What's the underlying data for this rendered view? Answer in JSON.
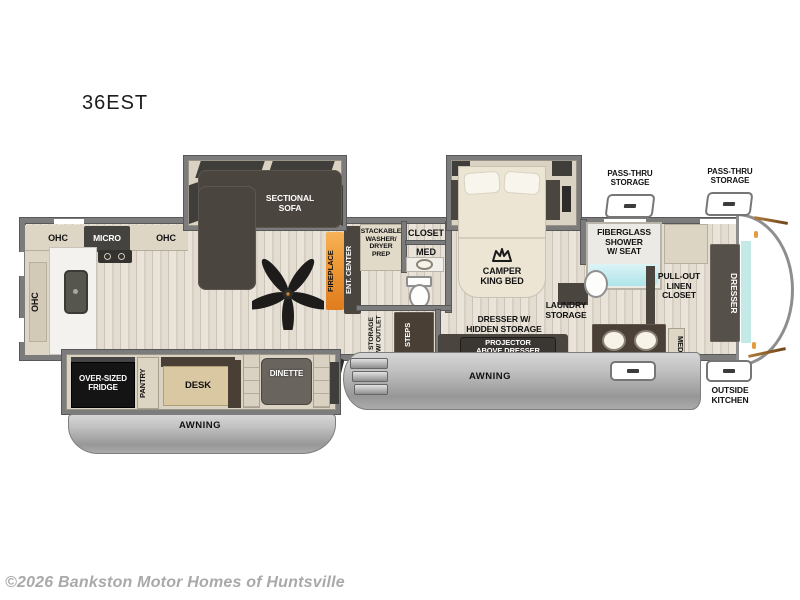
{
  "title": "36EST",
  "copyright": "©2026 Bankston Motor Homes of Huntsville",
  "labels": {
    "ohc": "OHC",
    "micro": "MICRO",
    "sectional_sofa": "SECTIONAL\nSOFA",
    "fireplace": "FIREPLACE",
    "ent_center": "ENT. CENTER",
    "stackable": "STACKABLE\nWASHER/\nDRYER\nPREP",
    "closet": "CLOSET",
    "med": "MED",
    "camper_king_bed": "CAMPER\nKING BED",
    "pass_thru": "PASS-THRU\nSTORAGE",
    "fiberglass_shower": "FIBERGLASS\nSHOWER\nW/ SEAT",
    "pull_out_linen": "PULL-OUT\nLINEN\nCLOSET",
    "dresser": "DRESSER",
    "laundry_storage": "LAUNDRY\nSTORAGE",
    "dresser_hidden": "DRESSER W/\nHIDDEN STORAGE",
    "projector": "PROJECTOR\nABOVE DRESSER",
    "storage_outlet": "STORAGE\nW/ OUTLET",
    "steps": "STEPS",
    "over_sized_fridge": "OVER-SIZED\nFRIDGE",
    "pantry": "PANTRY",
    "desk": "DESK",
    "dinette": "DINETTE",
    "awning": "AWNING",
    "outside_kitchen": "OUTSIDE\nKITCHEN"
  },
  "colors": {
    "wall_gray": "#7c7c7c",
    "floor_light": "#e6e0d5",
    "slide_beige": "#dad2c2",
    "furniture_dark": "#4b453f",
    "fireplace_accent": "#e8892c",
    "teal_accent": "#c4eae8",
    "awning_gray": "#ababab"
  }
}
